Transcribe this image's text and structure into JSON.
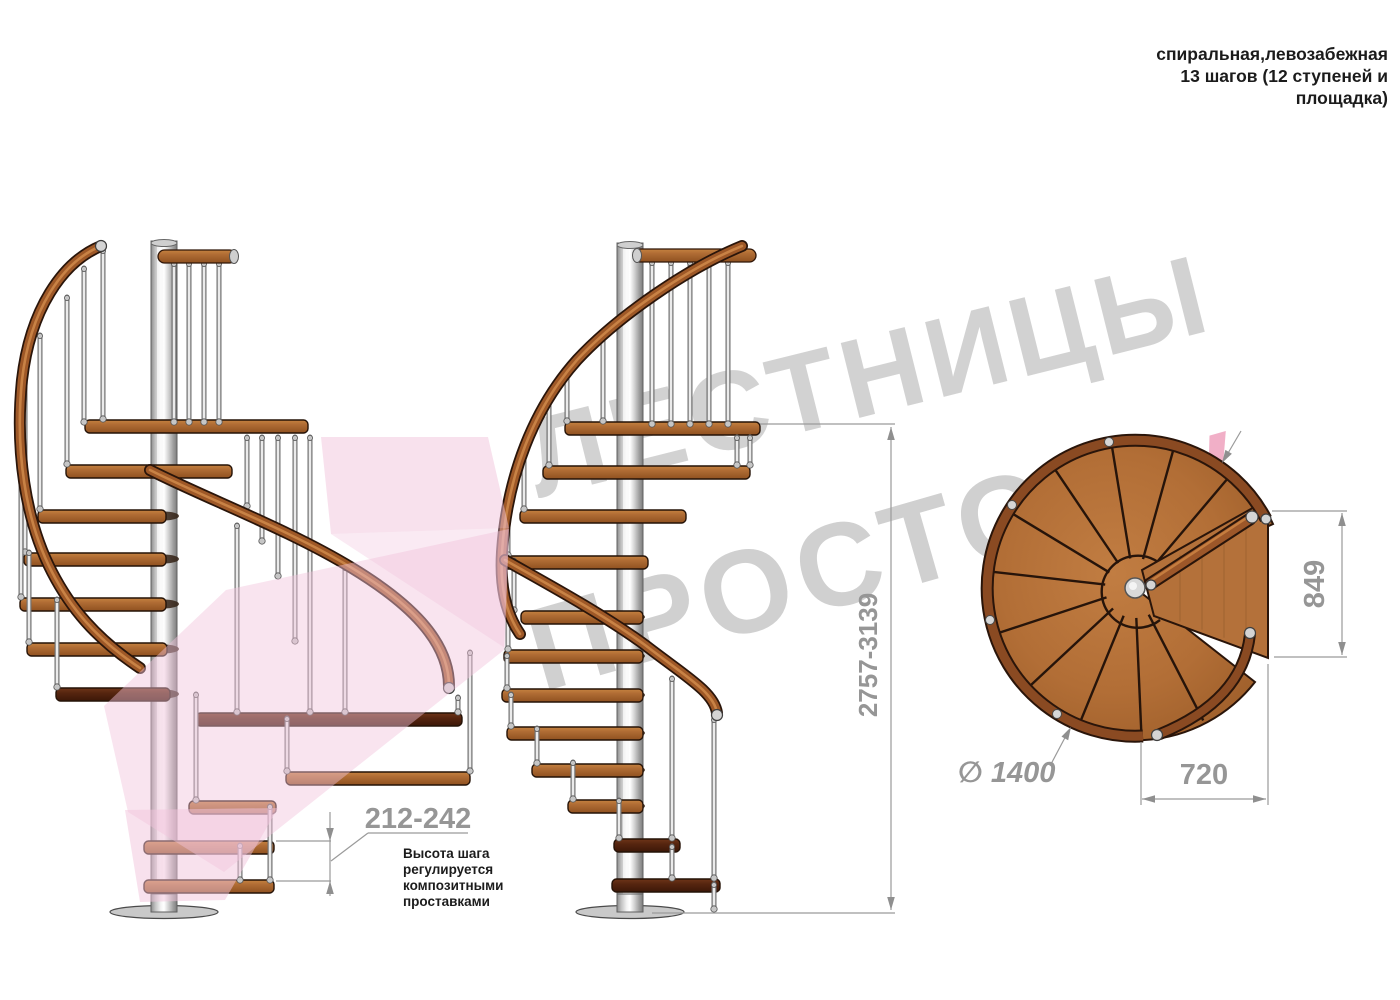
{
  "title_note": {
    "line1": "спиральная,левозабежная",
    "line2": "13 шагов (12 ступеней и",
    "line3": "площадка)"
  },
  "watermark": {
    "word1": "ЛЕСТНИЦЫ",
    "word2": "ПРОСТО",
    "word2_suffix": ".ру",
    "gray": "#cbcbcb",
    "pink": "#f0a7c2",
    "arrow_pink": "#f2c3dc"
  },
  "dimensions": {
    "step_height": {
      "value": "212-242",
      "note1": "Высота шага",
      "note2": "регулируется",
      "note3": "композитными",
      "note4": "проставками"
    },
    "total_height": {
      "value": "2757-3139"
    },
    "platform_depth": {
      "value": "849"
    },
    "platform_width": {
      "value": "720"
    },
    "diameter": {
      "value": "∅ 1400"
    }
  },
  "colors": {
    "wood": "#b06c34",
    "wood_dark": "#4a2012",
    "rail": "#9e5827",
    "metal": "#d9d9d9",
    "dim_text": "#969696",
    "dim_line": "#9a9a9a",
    "note_text": "#1c1c1c"
  }
}
